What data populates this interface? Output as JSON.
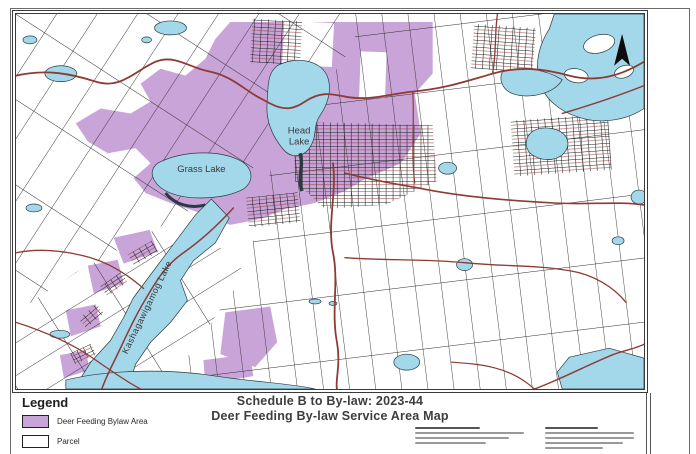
{
  "legend": {
    "title": "Legend",
    "items": [
      {
        "label": "Deer Feeding Bylaw Area",
        "swatch": "#c49fd8"
      },
      {
        "label": "Parcel",
        "swatch": "#ffffff"
      }
    ]
  },
  "title_block": {
    "line1": "Schedule B to By-law: 2023-44",
    "line2": "Deer Feeding By-law Service Area Map"
  },
  "map": {
    "labels": {
      "head_lake_line1": "Head",
      "head_lake_line2": "Lake",
      "grass_lake": "Grass Lake",
      "kashagawigamog": "Kashagawigamog Lake"
    }
  },
  "colors": {
    "water": "#a3d7ea",
    "water_outline": "#2b3a42",
    "bylaw_area": "#c9a4d9",
    "road": "#8e3b34",
    "parcel_line": "#2e2e2e"
  }
}
